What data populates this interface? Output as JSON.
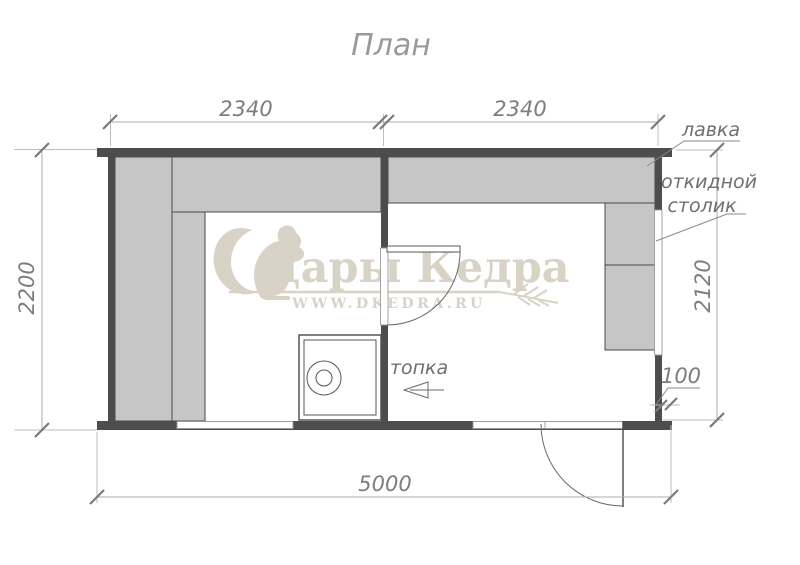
{
  "title": "План",
  "watermark": {
    "brand": "Дары Кедра",
    "url": "WWW.DKEDRA.RU",
    "logo_icon": "squirrel",
    "color": "#d9d2c6"
  },
  "dimensions": {
    "top_left": "2340",
    "top_right": "2340",
    "left": "2200",
    "right": "2120",
    "bottom": "5000",
    "overhang": "100"
  },
  "labels": {
    "bench": "лавка",
    "folding_table_line1": "откидной",
    "folding_table_line2": "столик",
    "furnace": "топка"
  },
  "colors": {
    "wall": "#4d4d4d",
    "bench": "#c6c6c6",
    "stove_outline": "#555555"
  }
}
